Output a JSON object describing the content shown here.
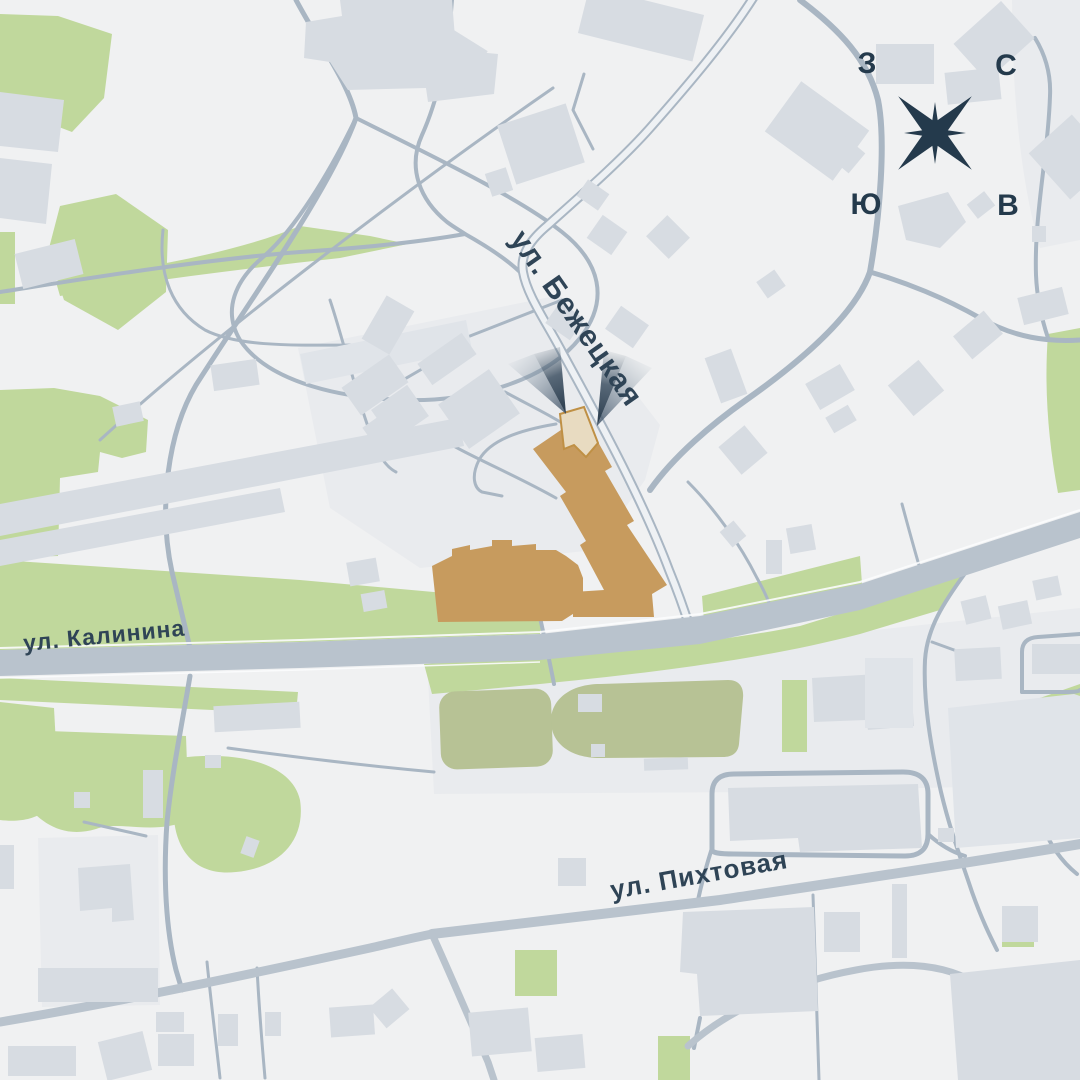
{
  "map": {
    "street_labels": [
      {
        "id": "bezhetskaya",
        "text": "ул. Бежецкая"
      },
      {
        "id": "kalinina",
        "text": "ул. Калинина"
      },
      {
        "id": "pikhtovaya",
        "text": "ул. Пихтовая"
      }
    ],
    "compass": {
      "north": "С",
      "south": "Ю",
      "west": "З",
      "east": "В"
    },
    "colors": {
      "background": "#f0f1f2",
      "parcel": "#e9ebee",
      "building": "#d7dce2",
      "building_light": "#e0e4e9",
      "green": "#c0d89c",
      "olive": "#b7c295",
      "road": "#a9b6c3",
      "road_major": "#b9c3cd",
      "road_inner": "#eef1f4",
      "label": "#2f4456",
      "compass": "#243a4c",
      "highlight": "#c79b5e",
      "highlight_light": "#e8dbc1",
      "highlight_outline": "#bf9045",
      "beam_dark": "#2d3f50",
      "beam_gray": "#8696a4"
    }
  }
}
